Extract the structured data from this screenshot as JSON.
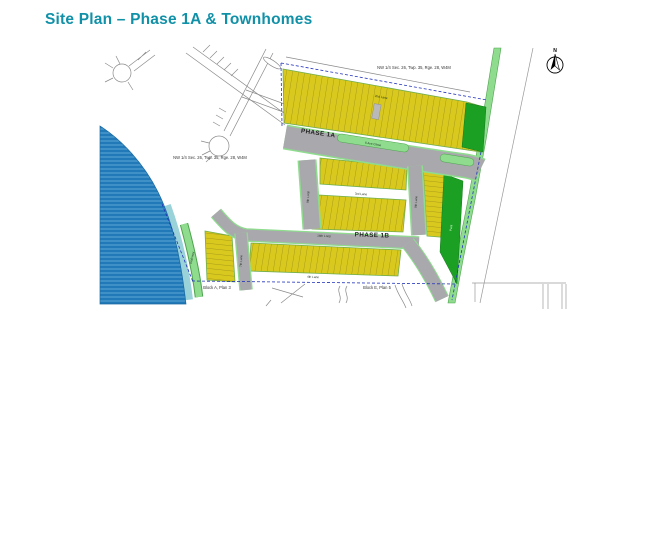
{
  "page": {
    "title": "Site Plan – Phase 1A & Townhomes"
  },
  "map": {
    "north_label": "N",
    "section_label": "NW 1/4 Sec. 26, Twp. 35, Rge. 28, W4M",
    "phase_1a_label": "PHASE 1A",
    "phase_1b_label": "PHASE 1B",
    "block_a_label": "Block A, Plan 3",
    "block_e_label": "Block E, Plan 5",
    "streets": {
      "boulevard": "5 Ave Close",
      "lane_top": "2nd Lane",
      "lane_mid": "3rd Lane",
      "loop_left": "9th Loop",
      "lane_right": "9th Lane",
      "lane_west": "7th Lane",
      "loop_south": "16th Loop",
      "lane_bottom": "4th Lane",
      "walkway": "Walkway",
      "park": "Park"
    }
  },
  "colors": {
    "accent_teal": "#1191a8",
    "lot_yellow": "#d9c91f",
    "lot_hatch": "#7a6e10",
    "green_light": "#8fdc8f",
    "green_dark": "#1ba024",
    "water_blue": "#2179b8",
    "water_stripe": "#5aa8d6",
    "shore_teal": "#9ad2da",
    "road_gray": "#a9a9ad",
    "boundary_blue": "#2233bb"
  }
}
